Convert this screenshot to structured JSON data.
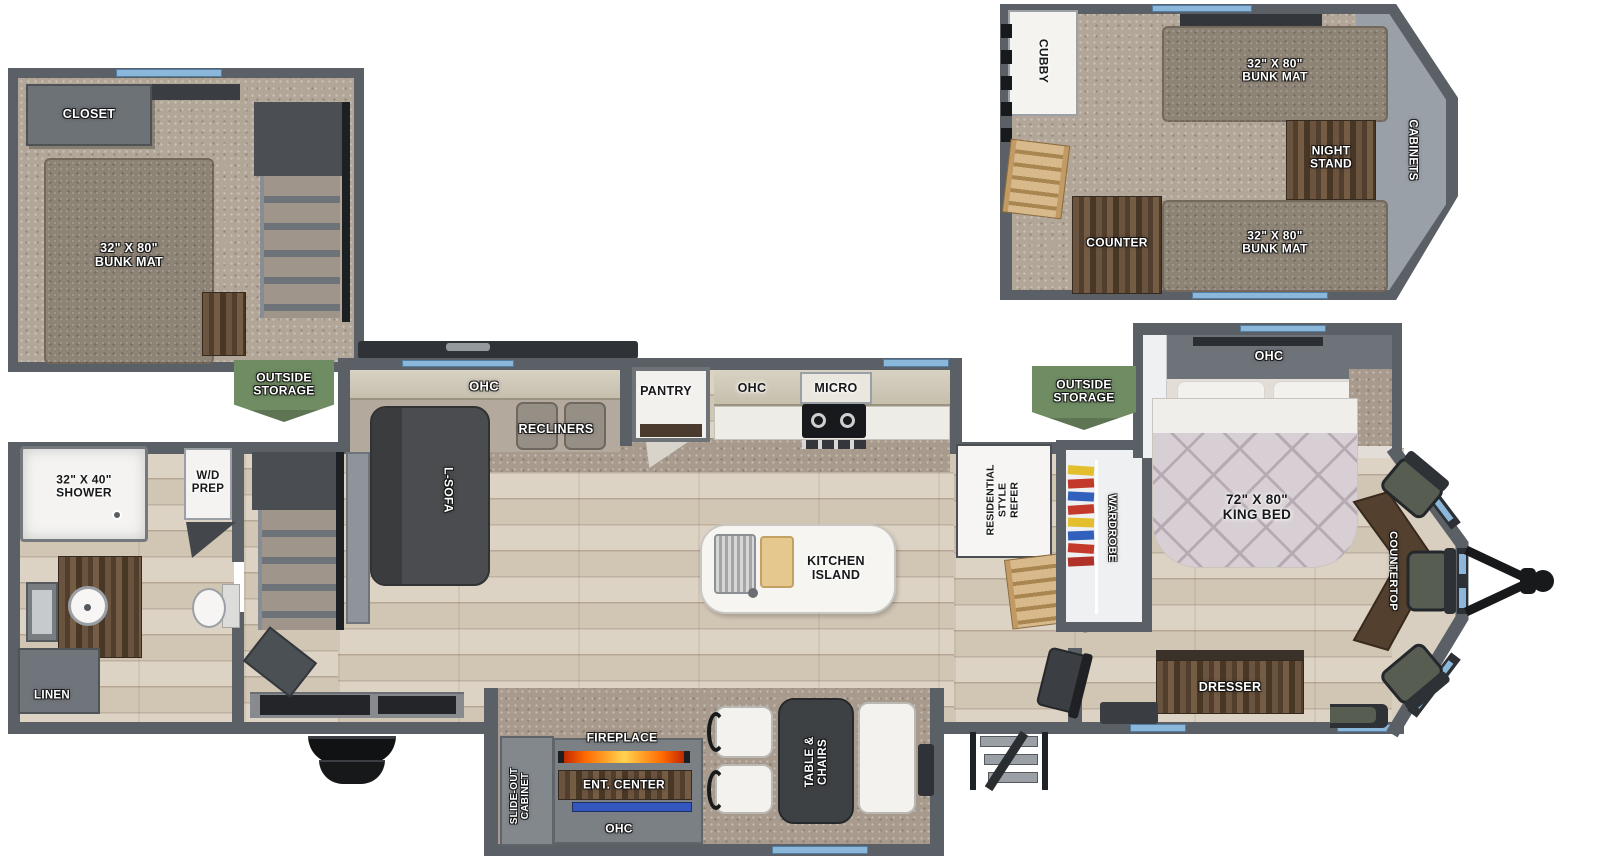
{
  "rear_loft": {
    "closet": "CLOSET",
    "bunk_mat": "32\" X 80\"\nBUNK MAT"
  },
  "front_loft": {
    "cubby": "CUBBY",
    "bunk_mat_top": "32\" X 80\"\nBUNK MAT",
    "night_stand": "NIGHT\nSTAND",
    "cabinets": "CABINETS",
    "counter": "COUNTER",
    "bunk_mat_bottom": "32\" X 80\"\nBUNK MAT"
  },
  "storage": {
    "left": "OUTSIDE\nSTORAGE",
    "right": "OUTSIDE\nSTORAGE"
  },
  "living": {
    "ohc": "OHC",
    "recliners": "RECLINERS",
    "l_sofa": "L-SOFA"
  },
  "kitchen": {
    "pantry": "PANTRY",
    "ohc": "OHC",
    "micro": "MICRO",
    "island": "KITCHEN\nISLAND",
    "refer": "RESIDENTIAL\nSTYLE\nREFER"
  },
  "bedroom": {
    "ohc": "OHC",
    "king_bed": "72\" X 80\"\nKING BED",
    "wardrobe": "WARDROBE",
    "dresser": "DRESSER",
    "countertop": "COUNTERTOP"
  },
  "bathroom": {
    "shower": "32\" X 40\"\nSHOWER",
    "wd_prep": "W/D\nPREP",
    "linen": "LINEN"
  },
  "dinette": {
    "slide_out_cabinet": "SLIDE-OUT\nCABINET",
    "fireplace": "FIREPLACE",
    "ent_center": "ENT. CENTER",
    "ohc": "OHC",
    "table_chairs": "TABLE &\nCHAIRS"
  },
  "colors": {
    "wall": "#5b6066",
    "window_blue": "#8bb7da",
    "storage_banner_green": "#6f8c63",
    "fireplace_accent": "#ff7a00",
    "tv_accent": "#3357bf",
    "wood_furniture": "#5a4634",
    "floor_wood": "#d9cfc0",
    "carpet": "#a89b8d"
  }
}
